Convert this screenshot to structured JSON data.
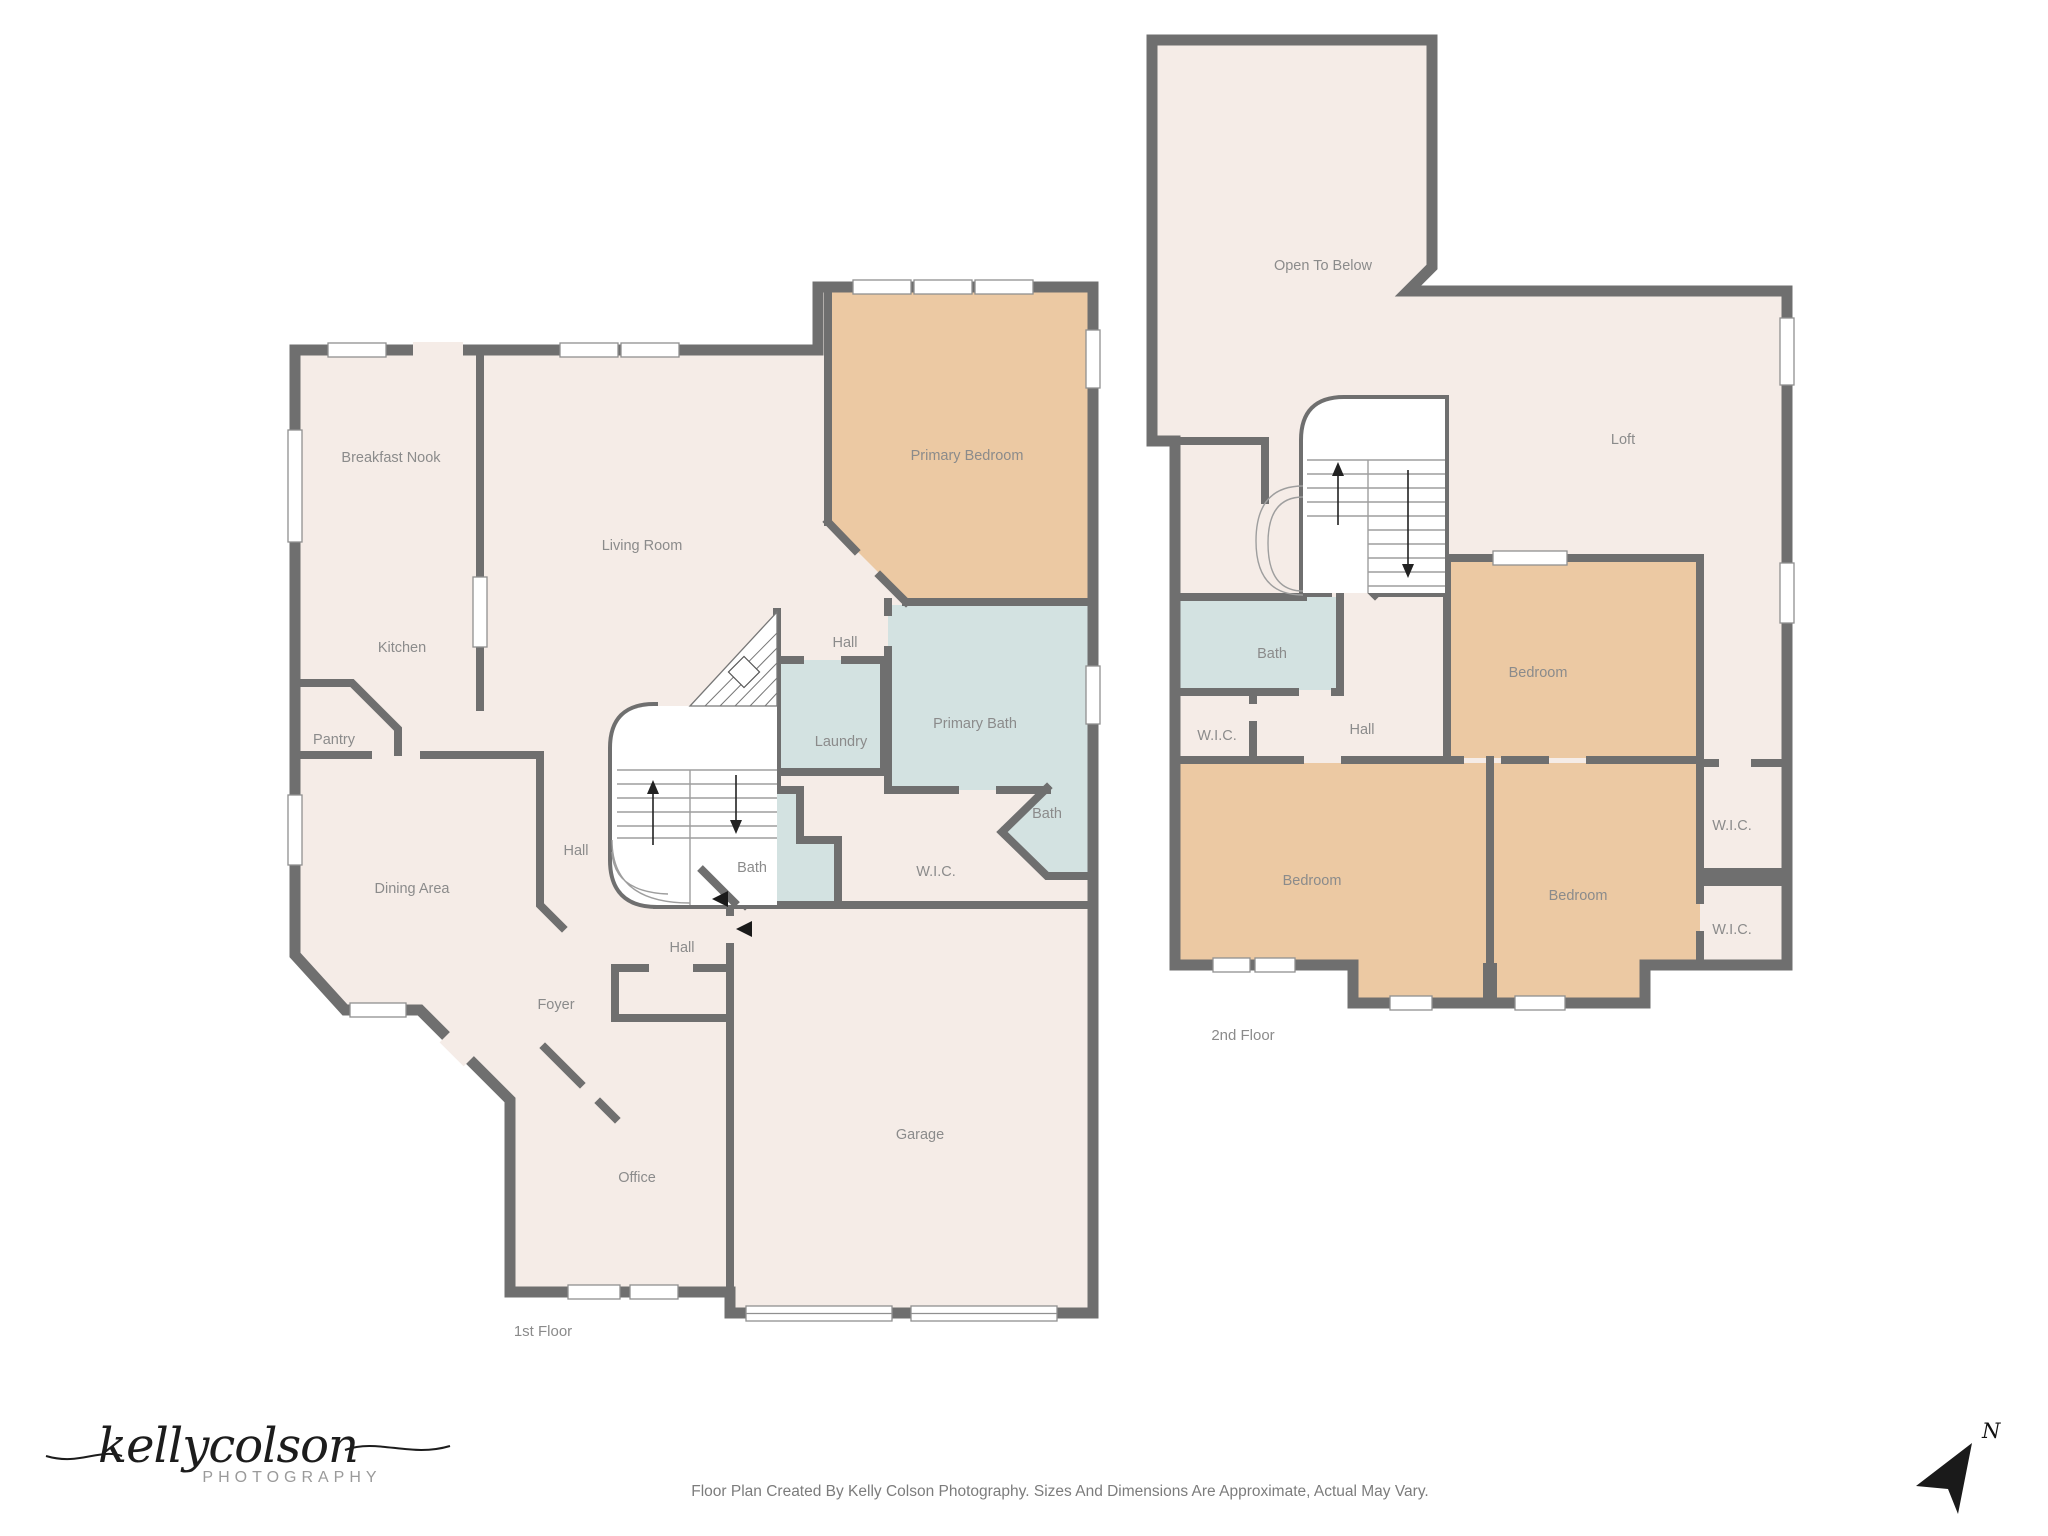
{
  "colors": {
    "wall": "#6f6f6f",
    "floor": "#f5ece7",
    "bedroom_fill": "#ecc9a3",
    "bath_fill": "#d3e2e1",
    "window": "#ffffff",
    "label": "#8b8b8b",
    "compass": "#1a1a1a"
  },
  "floor1": {
    "caption": "1st Floor",
    "rooms": {
      "breakfast_nook": "Breakfast Nook",
      "kitchen": "Kitchen",
      "pantry": "Pantry",
      "dining_area": "Dining Area",
      "living_room": "Living Room",
      "hall_upper": "Hall",
      "hall_center": "Hall",
      "hall_lower": "Hall",
      "foyer": "Foyer",
      "office": "Office",
      "garage": "Garage",
      "laundry": "Laundry",
      "primary_bedroom": "Primary Bedroom",
      "primary_bath": "Primary Bath",
      "bath_bay": "Bath",
      "bath": "Bath",
      "wic": "W.I.C."
    }
  },
  "floor2": {
    "caption": "2nd Floor",
    "rooms": {
      "open_to_below": "Open To Below",
      "loft": "Loft",
      "bath": "Bath",
      "wic_left": "W.I.C.",
      "hall": "Hall",
      "bedroom_ne": "Bedroom",
      "bedroom_sw": "Bedroom",
      "bedroom_s": "Bedroom",
      "wic_upper": "W.I.C.",
      "wic_lower": "W.I.C."
    }
  },
  "branding": {
    "logo_script": "kellycolson",
    "logo_sub": "PHOTOGRAPHY"
  },
  "footer": {
    "caption": "Floor Plan Created By Kelly Colson Photography. Sizes And Dimensions Are Approximate, Actual May Vary."
  },
  "compass": {
    "label": "N"
  }
}
